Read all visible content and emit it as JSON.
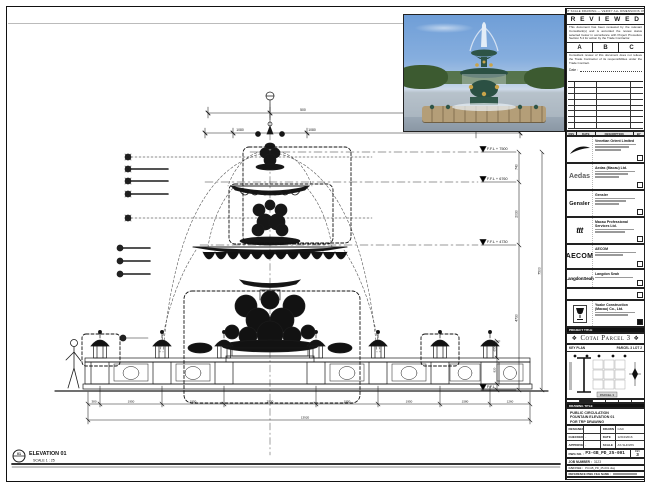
{
  "sheet": {
    "top_note": "DO NOT SCALE DRAWING — VERIFY ALL DIMENSIONS ON SITE"
  },
  "colors": {
    "line": "#1b1b1b",
    "paper": "#ffffff",
    "photo_sky": "#7fa8d6",
    "photo_foliage": "#3f5c33",
    "photo_patina": "#2e5a4c",
    "photo_gold": "#c9a44a",
    "photo_stone": "#b3a284"
  },
  "stamp": {
    "title": "R E V I E W E D",
    "para1": "This document has been reviewed by the relevant Consultant(s) and is accorded the review status selected below in accordance with Project Procedure Section 5.4 for action by the Trade Contractor.",
    "options": [
      "A",
      "B",
      "C"
    ],
    "para2": "Consultant review of this document does not relieve the Trade Contractor of its responsibilities under the Trade Contract.",
    "date_label": "Date :",
    "rev_header": [
      "REV",
      "DATE",
      "DESCRIPTION",
      "BY"
    ]
  },
  "consultants": [
    {
      "logo": "venetian-swoosh",
      "logo_text": "",
      "name": "Venetian Orient Limited"
    },
    {
      "logo": "aedas-logotype",
      "logo_text": "Aedas",
      "name": "Aedas (Macau) Ltd."
    },
    {
      "logo": "gensler-logotype",
      "logo_text": "Gensler",
      "name": "Gensler"
    },
    {
      "logo": "ttt-logotype",
      "logo_text": "ttt",
      "name": "Macau Professional Services Ltd."
    },
    {
      "logo": "aecom-logotype",
      "logo_text": "AECOM",
      "name": "AECOM"
    },
    {
      "logo": "langdonseah-logotype",
      "logo_text": "LangdonSeah",
      "name": "Langdon Seah"
    }
  ],
  "contractor": {
    "name": "Yuake Construction (Macau) Co., Ltd."
  },
  "project": {
    "label": "PROJECT TITLE",
    "title": "Cotai Parcel 3",
    "ornament": "❖"
  },
  "key_plan": {
    "label": "KEY PLAN",
    "right_label": "PARCEL 3  LOT 2",
    "note": "PARCEL 3"
  },
  "title_block": {
    "label": "DRAWING TITLE",
    "title_lines": [
      "PUBLIC CIRCULATION",
      "FOUNTAIN ELEVATION 01",
      "FOR TRP DRAWING"
    ],
    "info_rows": [
      {
        "l1": "DESIGNED",
        "v1": "",
        "l2": "DRAWN",
        "v2": "CAD"
      },
      {
        "l1": "CHECKED",
        "v1": "-",
        "l2": "DATE",
        "v2": "12/04/2016"
      },
      {
        "l1": "APPROVED",
        "v1": "-",
        "l2": "SCALE",
        "v2": "AS SHOWN"
      }
    ],
    "dwg_label": "DWG NO. :",
    "dwg_no": "P3-GB_PD_25-001",
    "rev_label": "REV",
    "rev": "3",
    "job_label": "JOB NUMBER :",
    "job": "3123",
    "cad_label": "CAD FILE :",
    "cad_file": "P3-GB_PD_25-001.dwg",
    "ref_label": "REFERENCE DWG FILE NAME :"
  },
  "drawing": {
    "view_label": "ELEVATION 01",
    "view_scale": "SCALE 1 : 25",
    "view_no": "01",
    "levels": [
      {
        "label": "F.F.L + 7500"
      },
      {
        "label": "F.F.L + 6760"
      },
      {
        "label": "F.F.L + 4730"
      },
      {
        "label": "F.F.L"
      }
    ],
    "vdims": [
      "740",
      "2030",
      "4730",
      "7500"
    ],
    "vdims_lamp": [
      "650",
      "820"
    ],
    "dims_top": [
      "500",
      "1080",
      "1080"
    ],
    "hdims_bottom": [
      "380",
      "1950",
      "1950",
      "2900",
      "1950",
      "1950",
      "1580",
      "1260"
    ],
    "total_dim": "13920"
  }
}
